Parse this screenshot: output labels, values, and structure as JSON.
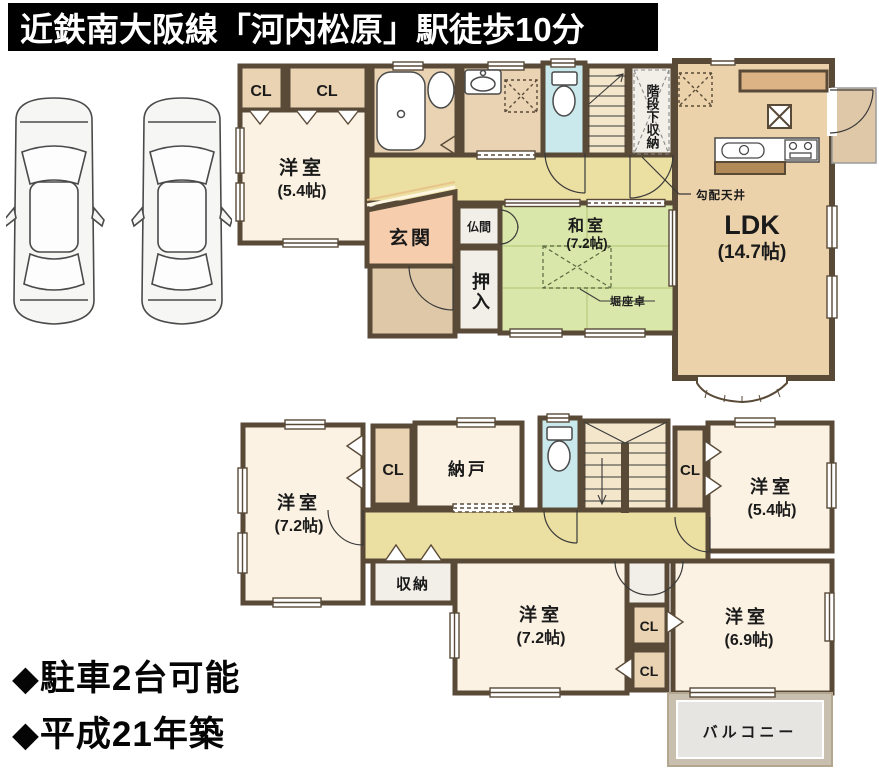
{
  "header": {
    "title": "近鉄南大阪線「河内松原」駅徒歩10分"
  },
  "parking_cars_drawn": 2,
  "floor1": {
    "cl1": "CL",
    "cl2": "CL",
    "yoshitsu": {
      "label": "洋室",
      "size": "(5.4帖)"
    },
    "genkan": "玄関",
    "butsuma": "仏間",
    "oshiire": "押入",
    "washitsu": {
      "label": "和室",
      "size": "(7.2帖)"
    },
    "ldk": {
      "label": "LDK",
      "size": "(14.7帖)"
    },
    "kaidan_shita": "階段下収納",
    "kobai_tenjo": "勾配天井",
    "horizataku": "堀座卓"
  },
  "floor2": {
    "yoshitsu_nw": {
      "label": "洋室",
      "size": "(7.2帖)"
    },
    "cl_nw": "CL",
    "nando": "納戸",
    "cl_ne": "CL",
    "yoshitsu_ne": {
      "label": "洋室",
      "size": "(5.4帖)"
    },
    "shuno": "収納",
    "yoshitsu_s": {
      "label": "洋室",
      "size": "(7.2帖)"
    },
    "cl_s1": "CL",
    "cl_s2": "CL",
    "yoshitsu_se": {
      "label": "洋室",
      "size": "(6.9帖)"
    },
    "balcony": "バルコニー"
  },
  "footer": {
    "line1": "◆駐車2台可能",
    "line2": "◆平成21年築"
  },
  "colors": {
    "wall": "#594a38",
    "room_cream": "#fbf2e3",
    "room_tan": "#e9d3b3",
    "ldk_tan": "#ebd2ab",
    "hall_yellow": "#ebdfa2",
    "tatami_green": "#d9e7aa",
    "toilet_blue": "#cae9ed",
    "genkan_salmon": "#f6cdad",
    "porch_tan": "#dfc8a8",
    "stairs_cream": "#f3e6cb",
    "white_room": "#f2efe8",
    "counter_dark": "#b28a58",
    "counter_tan": "#dcb384",
    "balcony_wall": "#c9bfae",
    "balcony_floor": "#e6e5e2",
    "header_bg": "#000000",
    "header_text": "#ffffff"
  }
}
